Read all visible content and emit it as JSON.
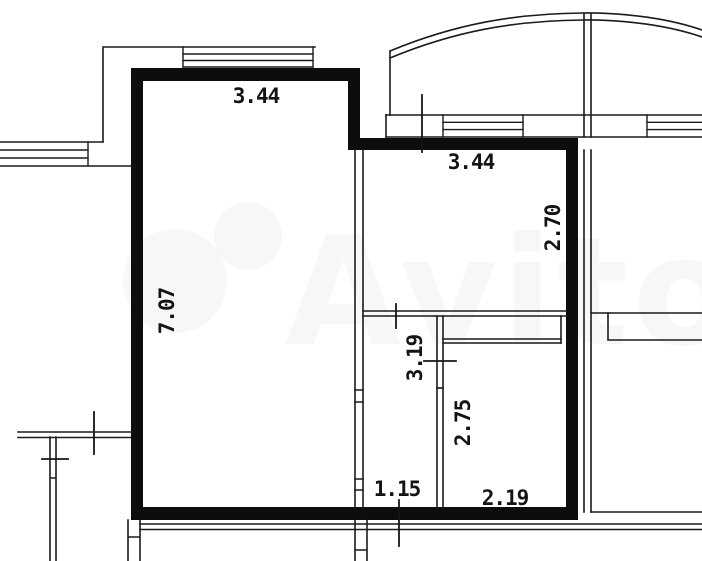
{
  "watermark": {
    "text": "Avito"
  },
  "colors": {
    "background": "#ffffff",
    "wall": "#0d0d0d",
    "line": "#1a1a1a",
    "label": "#141414",
    "watermark": "#8d8778"
  },
  "dimensions": {
    "main_room_width": "3.44",
    "kitchen_width": "3.44",
    "main_room_depth": "7.07",
    "kitchen_depth": "2.70",
    "hall_depth": "3.19",
    "bath_depth": "2.75",
    "hall_width": "1.15",
    "bath_width": "2.19"
  }
}
